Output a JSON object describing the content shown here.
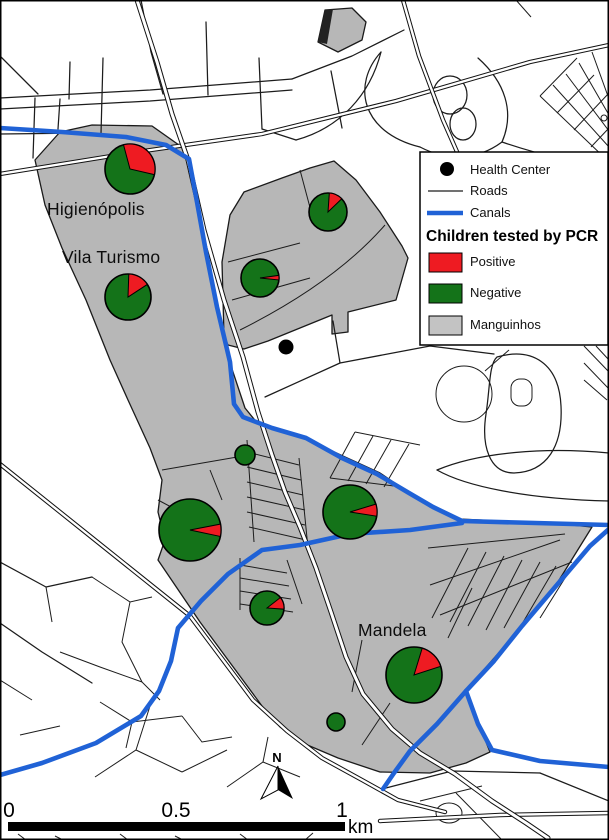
{
  "map": {
    "labels": [
      {
        "text": "Higienópolis"
      },
      {
        "text": "Vila Turismo"
      },
      {
        "text": "Mandela"
      }
    ],
    "health_centers": [
      {
        "x": 286,
        "y": 347,
        "r": 7.5
      }
    ],
    "north_label": "N"
  },
  "legend": {
    "title": "Children tested by PCR",
    "items": [
      {
        "label": "Health Center",
        "symbol": "health-center-dot"
      },
      {
        "label": "Roads",
        "symbol": "road-line"
      },
      {
        "label": "Canals",
        "symbol": "canal-line"
      },
      {
        "label": "Positive",
        "symbol": "positive-swatch"
      },
      {
        "label": "Negative",
        "symbol": "negative-swatch"
      },
      {
        "label": "Manguinhos",
        "symbol": "manguinhos-swatch"
      }
    ]
  },
  "scale_bar": {
    "ticks": [
      "0",
      "0.5",
      "1"
    ],
    "unit": "km"
  },
  "colors": {
    "positive": "#ee1b22",
    "negative": "#147319",
    "manguinhos": "#b7b7b7",
    "canal": "#2062d6",
    "road": "#1c1c1c",
    "background": "#ffffff"
  },
  "chart_data": {
    "type": "pie",
    "title": "Children tested by PCR",
    "legend_entries": [
      "Positive",
      "Negative"
    ],
    "note": "Pie charts located on map; values are share of children testing positive vs negative by PCR at each site",
    "pies": [
      {
        "id": "higienopolis",
        "cx": 130,
        "cy": 169,
        "r": 25,
        "positive_pct": 33,
        "wedge_start_deg": -15,
        "wedge_end_deg": 103
      },
      {
        "id": "vila-turismo",
        "cx": 128,
        "cy": 297,
        "r": 23,
        "positive_pct": 15,
        "wedge_start_deg": 2,
        "wedge_end_deg": 57
      },
      {
        "id": "northeast-upper",
        "cx": 328,
        "cy": 212,
        "r": 19,
        "positive_pct": 12,
        "wedge_start_deg": 4,
        "wedge_end_deg": 46
      },
      {
        "id": "northeast-lower",
        "cx": 260,
        "cy": 278,
        "r": 19,
        "positive_pct": 4,
        "wedge_start_deg": 82,
        "wedge_end_deg": 96
      },
      {
        "id": "center-small",
        "cx": 245,
        "cy": 455,
        "r": 10,
        "positive_pct": 0,
        "wedge_start_deg": 0,
        "wedge_end_deg": 0
      },
      {
        "id": "west-large",
        "cx": 190,
        "cy": 530,
        "r": 31,
        "positive_pct": 6,
        "wedge_start_deg": 79,
        "wedge_end_deg": 102
      },
      {
        "id": "central",
        "cx": 350,
        "cy": 512,
        "r": 27,
        "positive_pct": 7,
        "wedge_start_deg": 73,
        "wedge_end_deg": 99
      },
      {
        "id": "south-small",
        "cx": 267,
        "cy": 608,
        "r": 17,
        "positive_pct": 12,
        "wedge_start_deg": 52,
        "wedge_end_deg": 94
      },
      {
        "id": "mandela",
        "cx": 414,
        "cy": 675,
        "r": 28,
        "positive_pct": 15,
        "wedge_start_deg": 17,
        "wedge_end_deg": 72
      },
      {
        "id": "south-tiny",
        "cx": 336,
        "cy": 722,
        "r": 9,
        "positive_pct": 0,
        "wedge_start_deg": 0,
        "wedge_end_deg": 0
      }
    ]
  }
}
